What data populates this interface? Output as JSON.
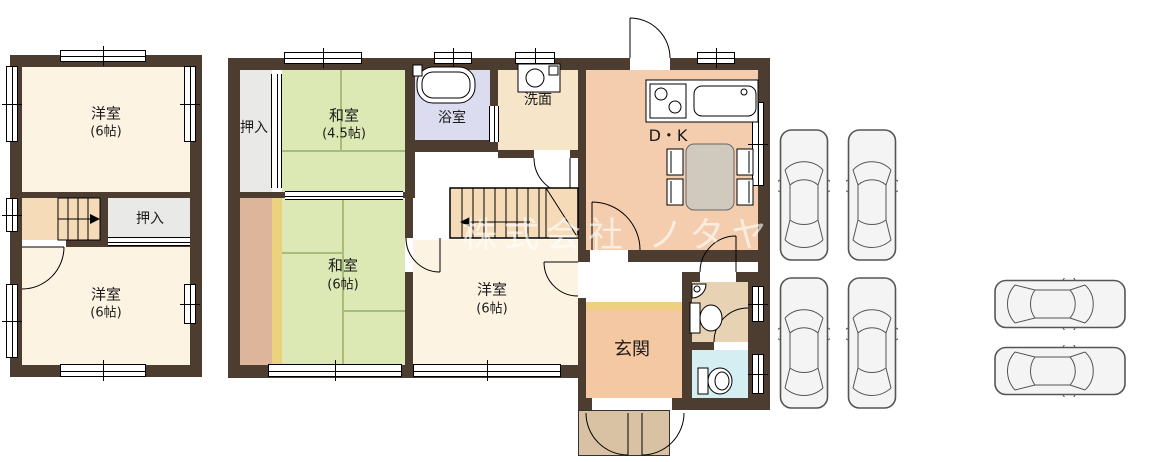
{
  "watermark": "株式会社 ノタヤ",
  "floor2": {
    "yoshitsu_top": {
      "name": "洋室",
      "size": "(6帖)"
    },
    "yoshitsu_bottom": {
      "name": "洋室",
      "size": "(6帖)"
    },
    "oshiire": "押入"
  },
  "floor1": {
    "oshiire": "押入",
    "washitsu_small": {
      "name": "和室",
      "size": "(4.5帖)"
    },
    "washitsu": {
      "name": "和室",
      "size": "(6帖)"
    },
    "yoshitsu": {
      "name": "洋室",
      "size": "(6帖)"
    },
    "bathroom": "浴室",
    "washroom": "洗面",
    "dining_kitchen": "D・K",
    "entrance": "玄関"
  },
  "parking": {
    "car_count": 6
  },
  "colors": {
    "wall": "#4c3d30",
    "western_room": "#fdf3e3",
    "tatami": "#dce9b4",
    "closet": "#e9e9e7",
    "stairs": "#f5dbb8",
    "bath": "#dcdcf1",
    "washroom": "#f7e5c9",
    "dining_kitchen": "#f4cdae",
    "entrance": "#f4c8a2",
    "entrance_step": "#eed080",
    "toilet": "#e7d2b3",
    "second_toilet": "#d5eef2",
    "porch": "#d8c2a3",
    "veranda": "#dcb59b",
    "veranda_edge": "#ecd27c"
  }
}
